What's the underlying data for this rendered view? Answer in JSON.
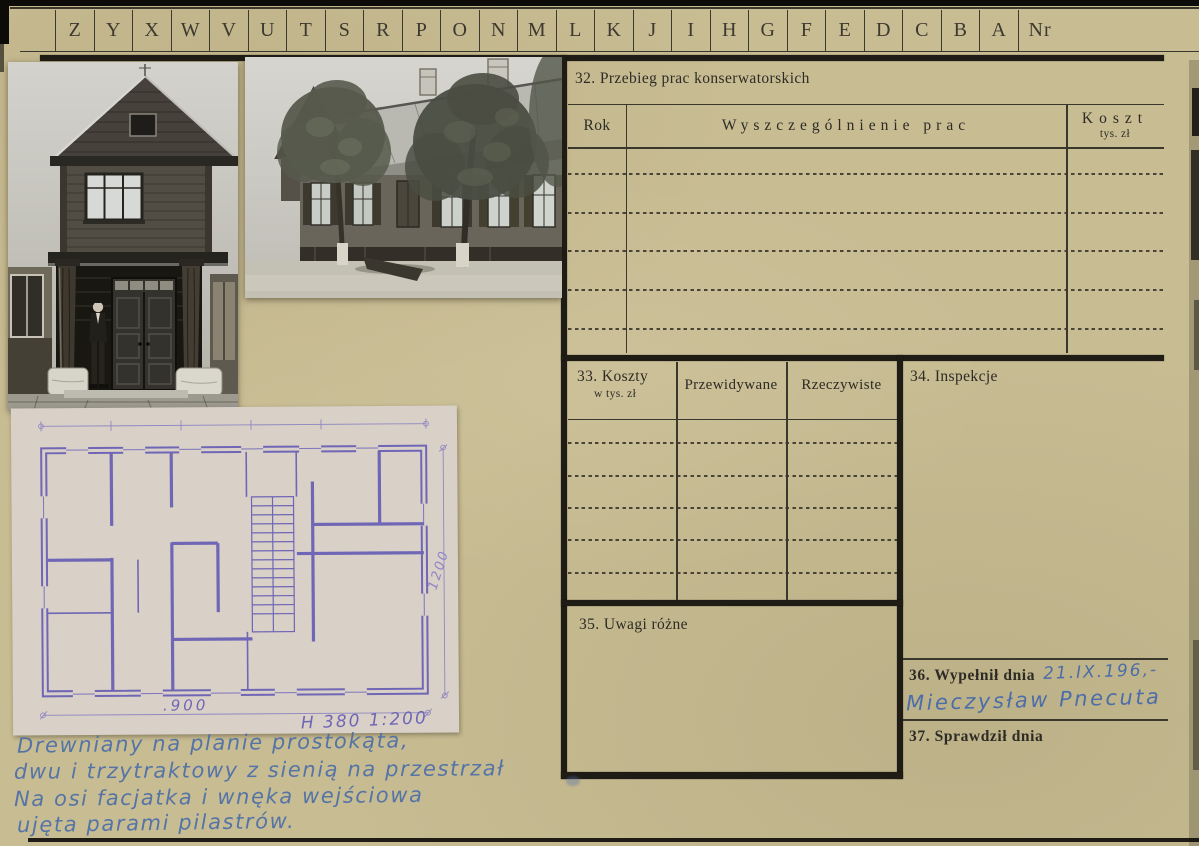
{
  "colors": {
    "paper": "#c8bc93",
    "ink": "#2d2b24",
    "blue_ink": "#4c6ea8",
    "plan_paper": "#d9d0c8",
    "plan_ink": "#6f66b6",
    "bar": "#1f1c16"
  },
  "tab_strip": {
    "letters": [
      "Z",
      "Y",
      "X",
      "W",
      "V",
      "U",
      "T",
      "S",
      "R",
      "P",
      "O",
      "N",
      "M",
      "L",
      "K",
      "J",
      "I",
      "H",
      "G",
      "F",
      "E",
      "D",
      "C",
      "B",
      "A"
    ],
    "nr_label": "Nr"
  },
  "s32": {
    "title": "32. Przebieg prac konserwatorskich",
    "col_rok": "Rok",
    "col_works": "Wyszczególnienie prac",
    "col_cost": "Koszt",
    "col_cost_sub": "tys. zł",
    "empty_rows": 5
  },
  "s33": {
    "title": "33. Koszty",
    "title_sub": "w tys. zł",
    "col_expected": "Przewidywane",
    "col_actual": "Rzeczywiste",
    "empty_rows": 5
  },
  "s34": {
    "title": "34. Inspekcje"
  },
  "s35": {
    "title": "35. Uwagi różne"
  },
  "s36": {
    "label": "36. Wypełnił dnia",
    "date_handwritten": "21.IX.196,-",
    "signature_handwritten": "Mieczysław Pnecuta"
  },
  "s37": {
    "label": "37. Sprawdził dnia"
  },
  "plan": {
    "dim_width": ".900",
    "scale_note": "H 380 1:200",
    "dim_height": "1200"
  },
  "notes": {
    "lines": [
      "Drewniany na planie prostokąta,",
      "dwu i trzytraktowy z sienią na przestrzał",
      "Na osi facjatka i wnęka wejściowa",
      "ujęta parami pilastrów."
    ]
  },
  "photos": {
    "photo1_alt": "wooden gatehouse with man standing in doorway",
    "photo2_alt": "long wooden house facade with two trees"
  }
}
